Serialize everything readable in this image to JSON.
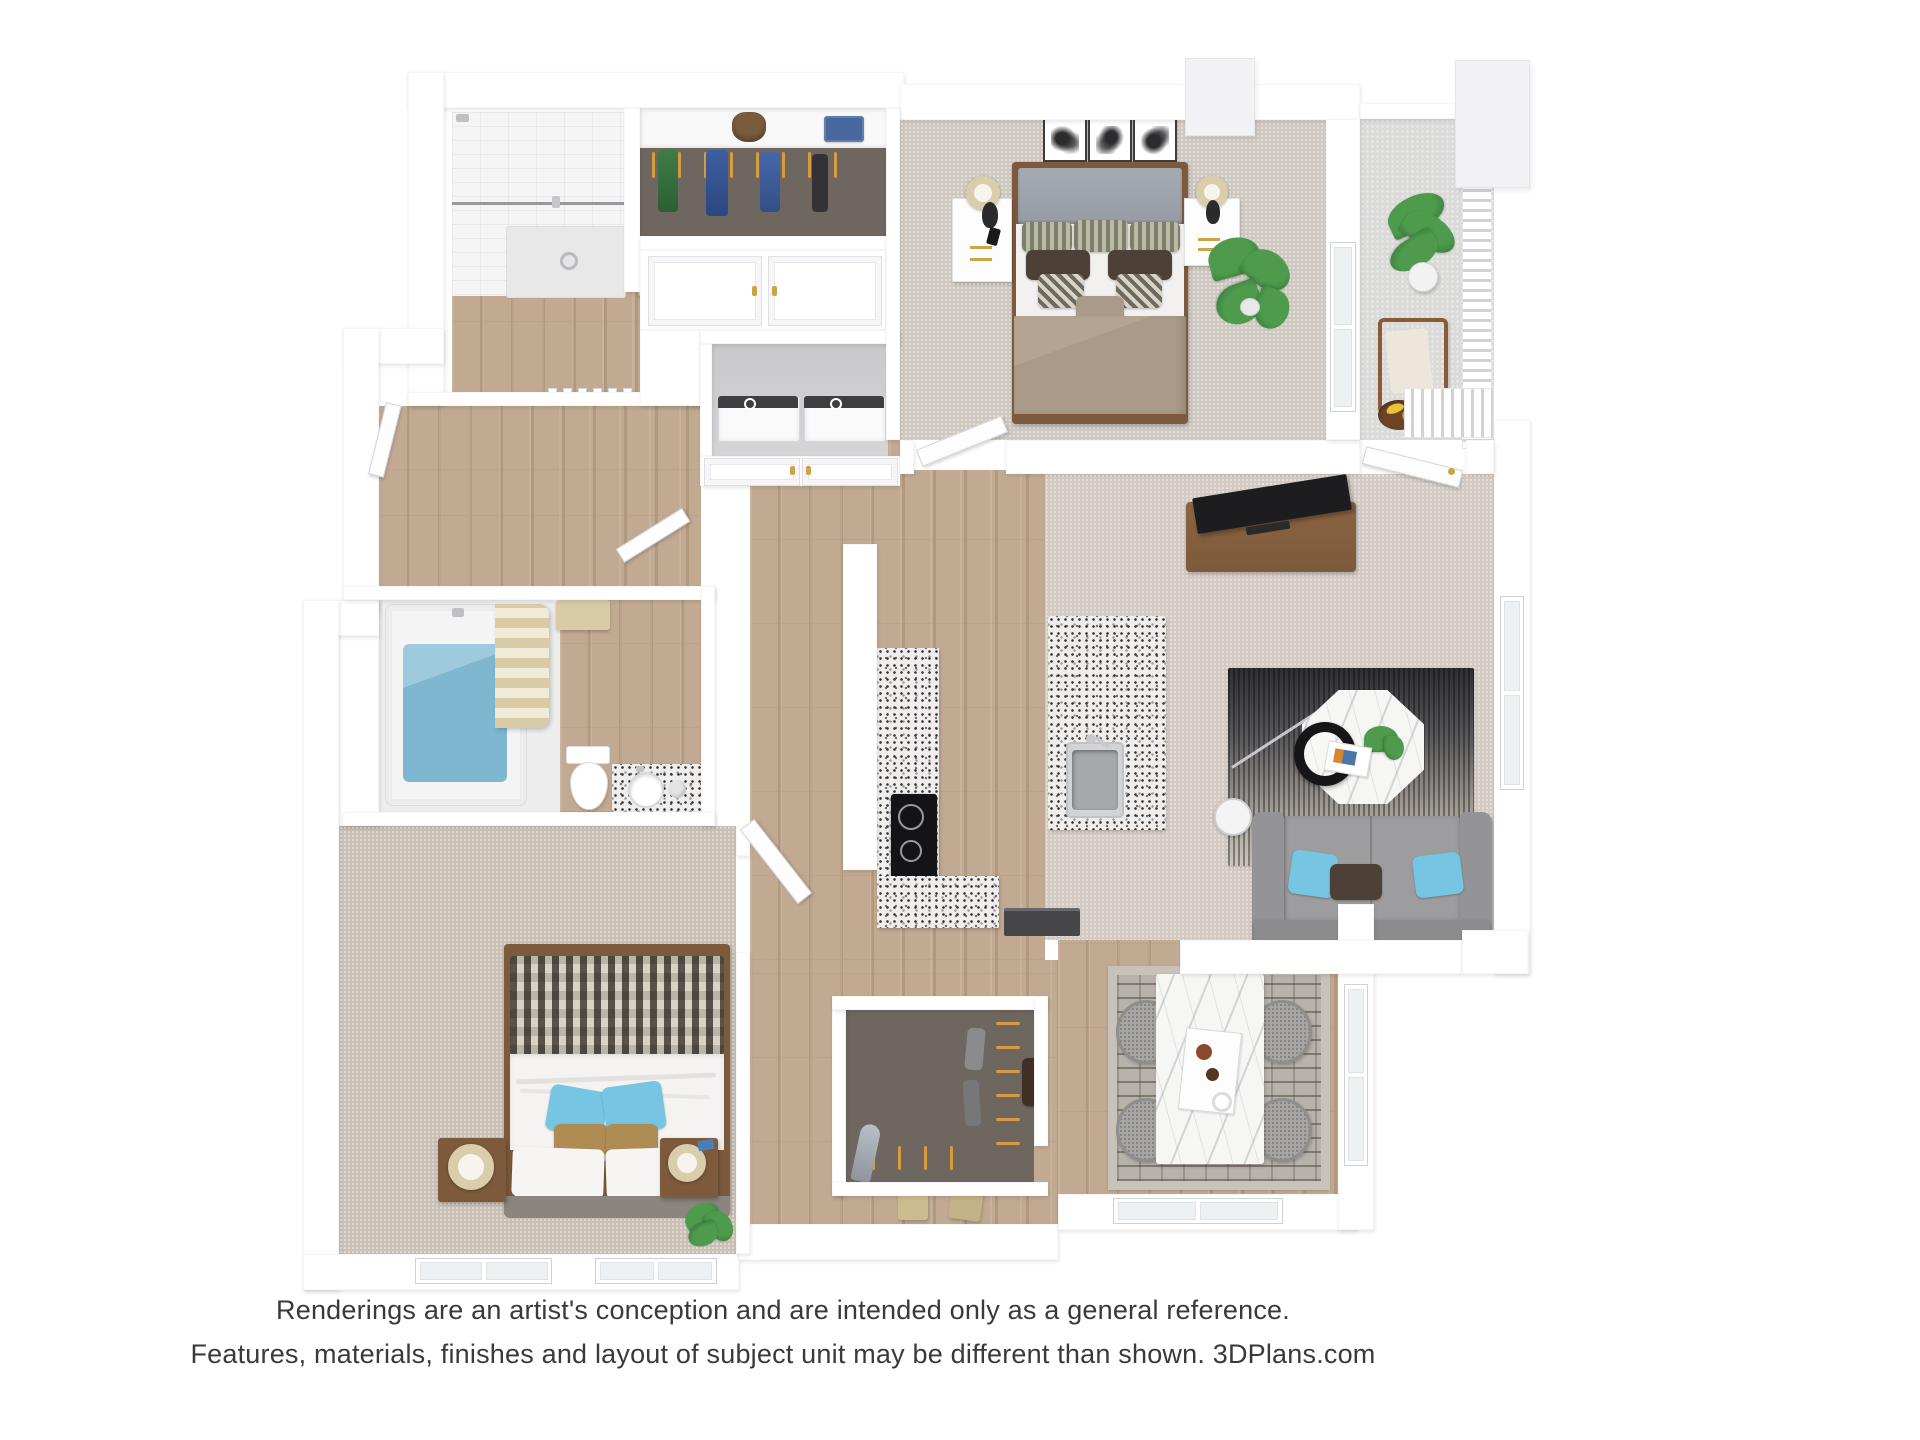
{
  "disclaimer": {
    "line1": "Renderings are an artist's conception and are intended only as a general reference.",
    "line2": "Features, materials, finishes and layout of subject unit may be different than shown. 3DPlans.com"
  },
  "palette": {
    "bg": "#ffffff",
    "wall": "#ffffff",
    "wall_edge": "#e2e2e6",
    "wood": "#c2aa92",
    "wood_dark": "#b1997f",
    "carpet_master": "#cfc8c1",
    "carpet_living": "#d3cbc3",
    "carpet_bedroom2": "#c9bfb5",
    "closet_floor": "#6e675f",
    "laundry_floor": "#d5d5d7",
    "bath_floor": "#ededee",
    "tile": "#f5f5f6",
    "granite_base": "#efeeec",
    "marble": "#f6f6f5",
    "balcony_floor": "#dadad8",
    "water": "#7fb7d0",
    "towel": "#d9cba6",
    "hanger": "#d79b3f",
    "sofa": "#9d9c9e",
    "sofa_dark": "#8c8b8e",
    "pillow_blue": "#76c5e2",
    "pillow_brown": "#4c4037",
    "pillow_tan": "#b08c55",
    "duvet": "#a99b88",
    "headboard_master": "#979ca4",
    "headboard_bedroom2": "#8a857d",
    "furniture_wood": "#7d5a3b",
    "lamp_beige": "#d9cdab",
    "plant": "#4e9b4d",
    "plant_dark": "#2f6e33",
    "dining_rug": "#b8b3aa",
    "chair": "#a7a6a4",
    "appliance_dark": "#47474a",
    "text": "#3a3a3a"
  }
}
